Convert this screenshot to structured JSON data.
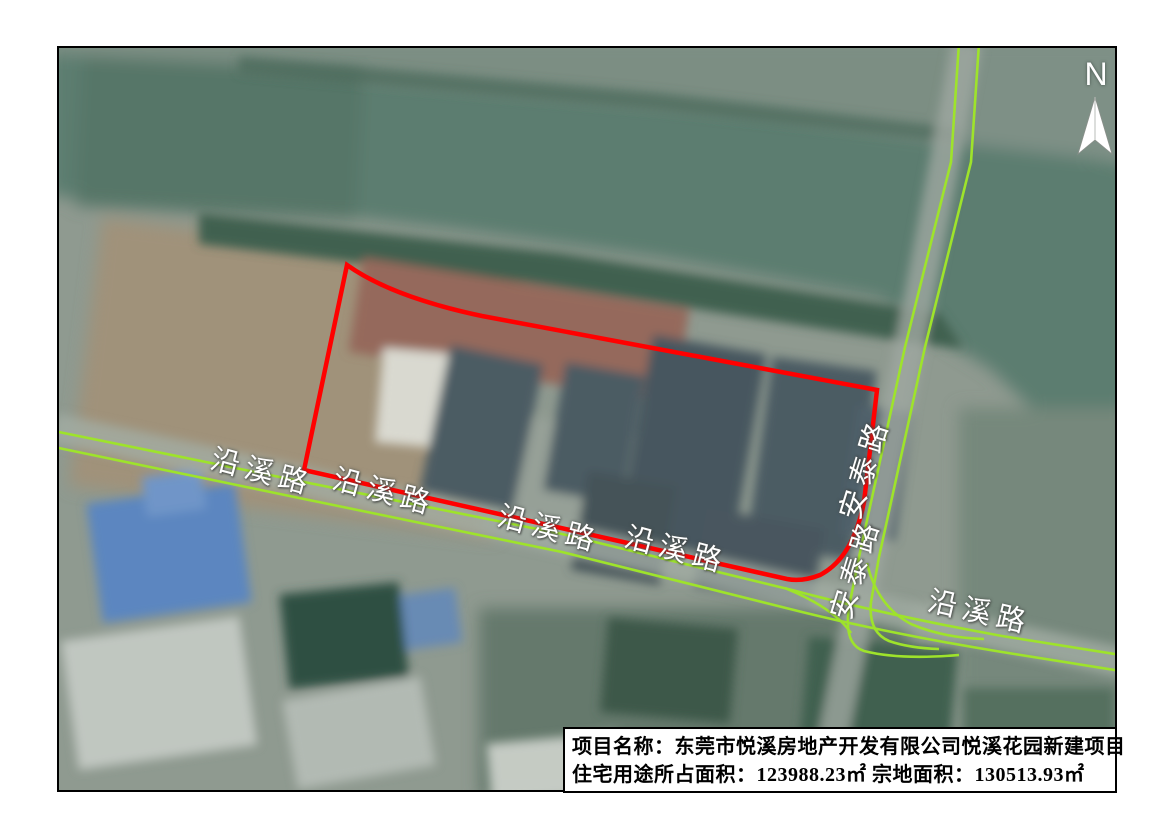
{
  "map": {
    "north": {
      "label": "N"
    },
    "colors": {
      "road_line": "#9ee32b",
      "project_boundary": "#ff0000",
      "water": "#5c7d6f",
      "label_text": "#ffffff"
    },
    "roads": {
      "labels": [
        {
          "text": "沿溪路",
          "x": 153,
          "y": 404,
          "rot": 15
        },
        {
          "text": "沿溪路",
          "x": 275,
          "y": 424,
          "rot": 15
        },
        {
          "text": "沿溪路",
          "x": 440,
          "y": 461,
          "rot": 15
        },
        {
          "text": "沿溪路",
          "x": 567,
          "y": 482,
          "rot": 15
        },
        {
          "text": "沿溪路",
          "x": 870,
          "y": 546,
          "rot": 13
        },
        {
          "text": "安泰路",
          "x": 788,
          "y": 466,
          "rot": -73
        },
        {
          "text": "安泰路",
          "x": 779,
          "y": 566,
          "rot": -73
        }
      ]
    },
    "info_box": {
      "line1": "项目名称：东莞市悦溪房地产开发有限公司悦溪花园新建项目",
      "line2": "住宅用途所占面积：123988.23㎡ 宗地面积：130513.93㎡"
    }
  }
}
